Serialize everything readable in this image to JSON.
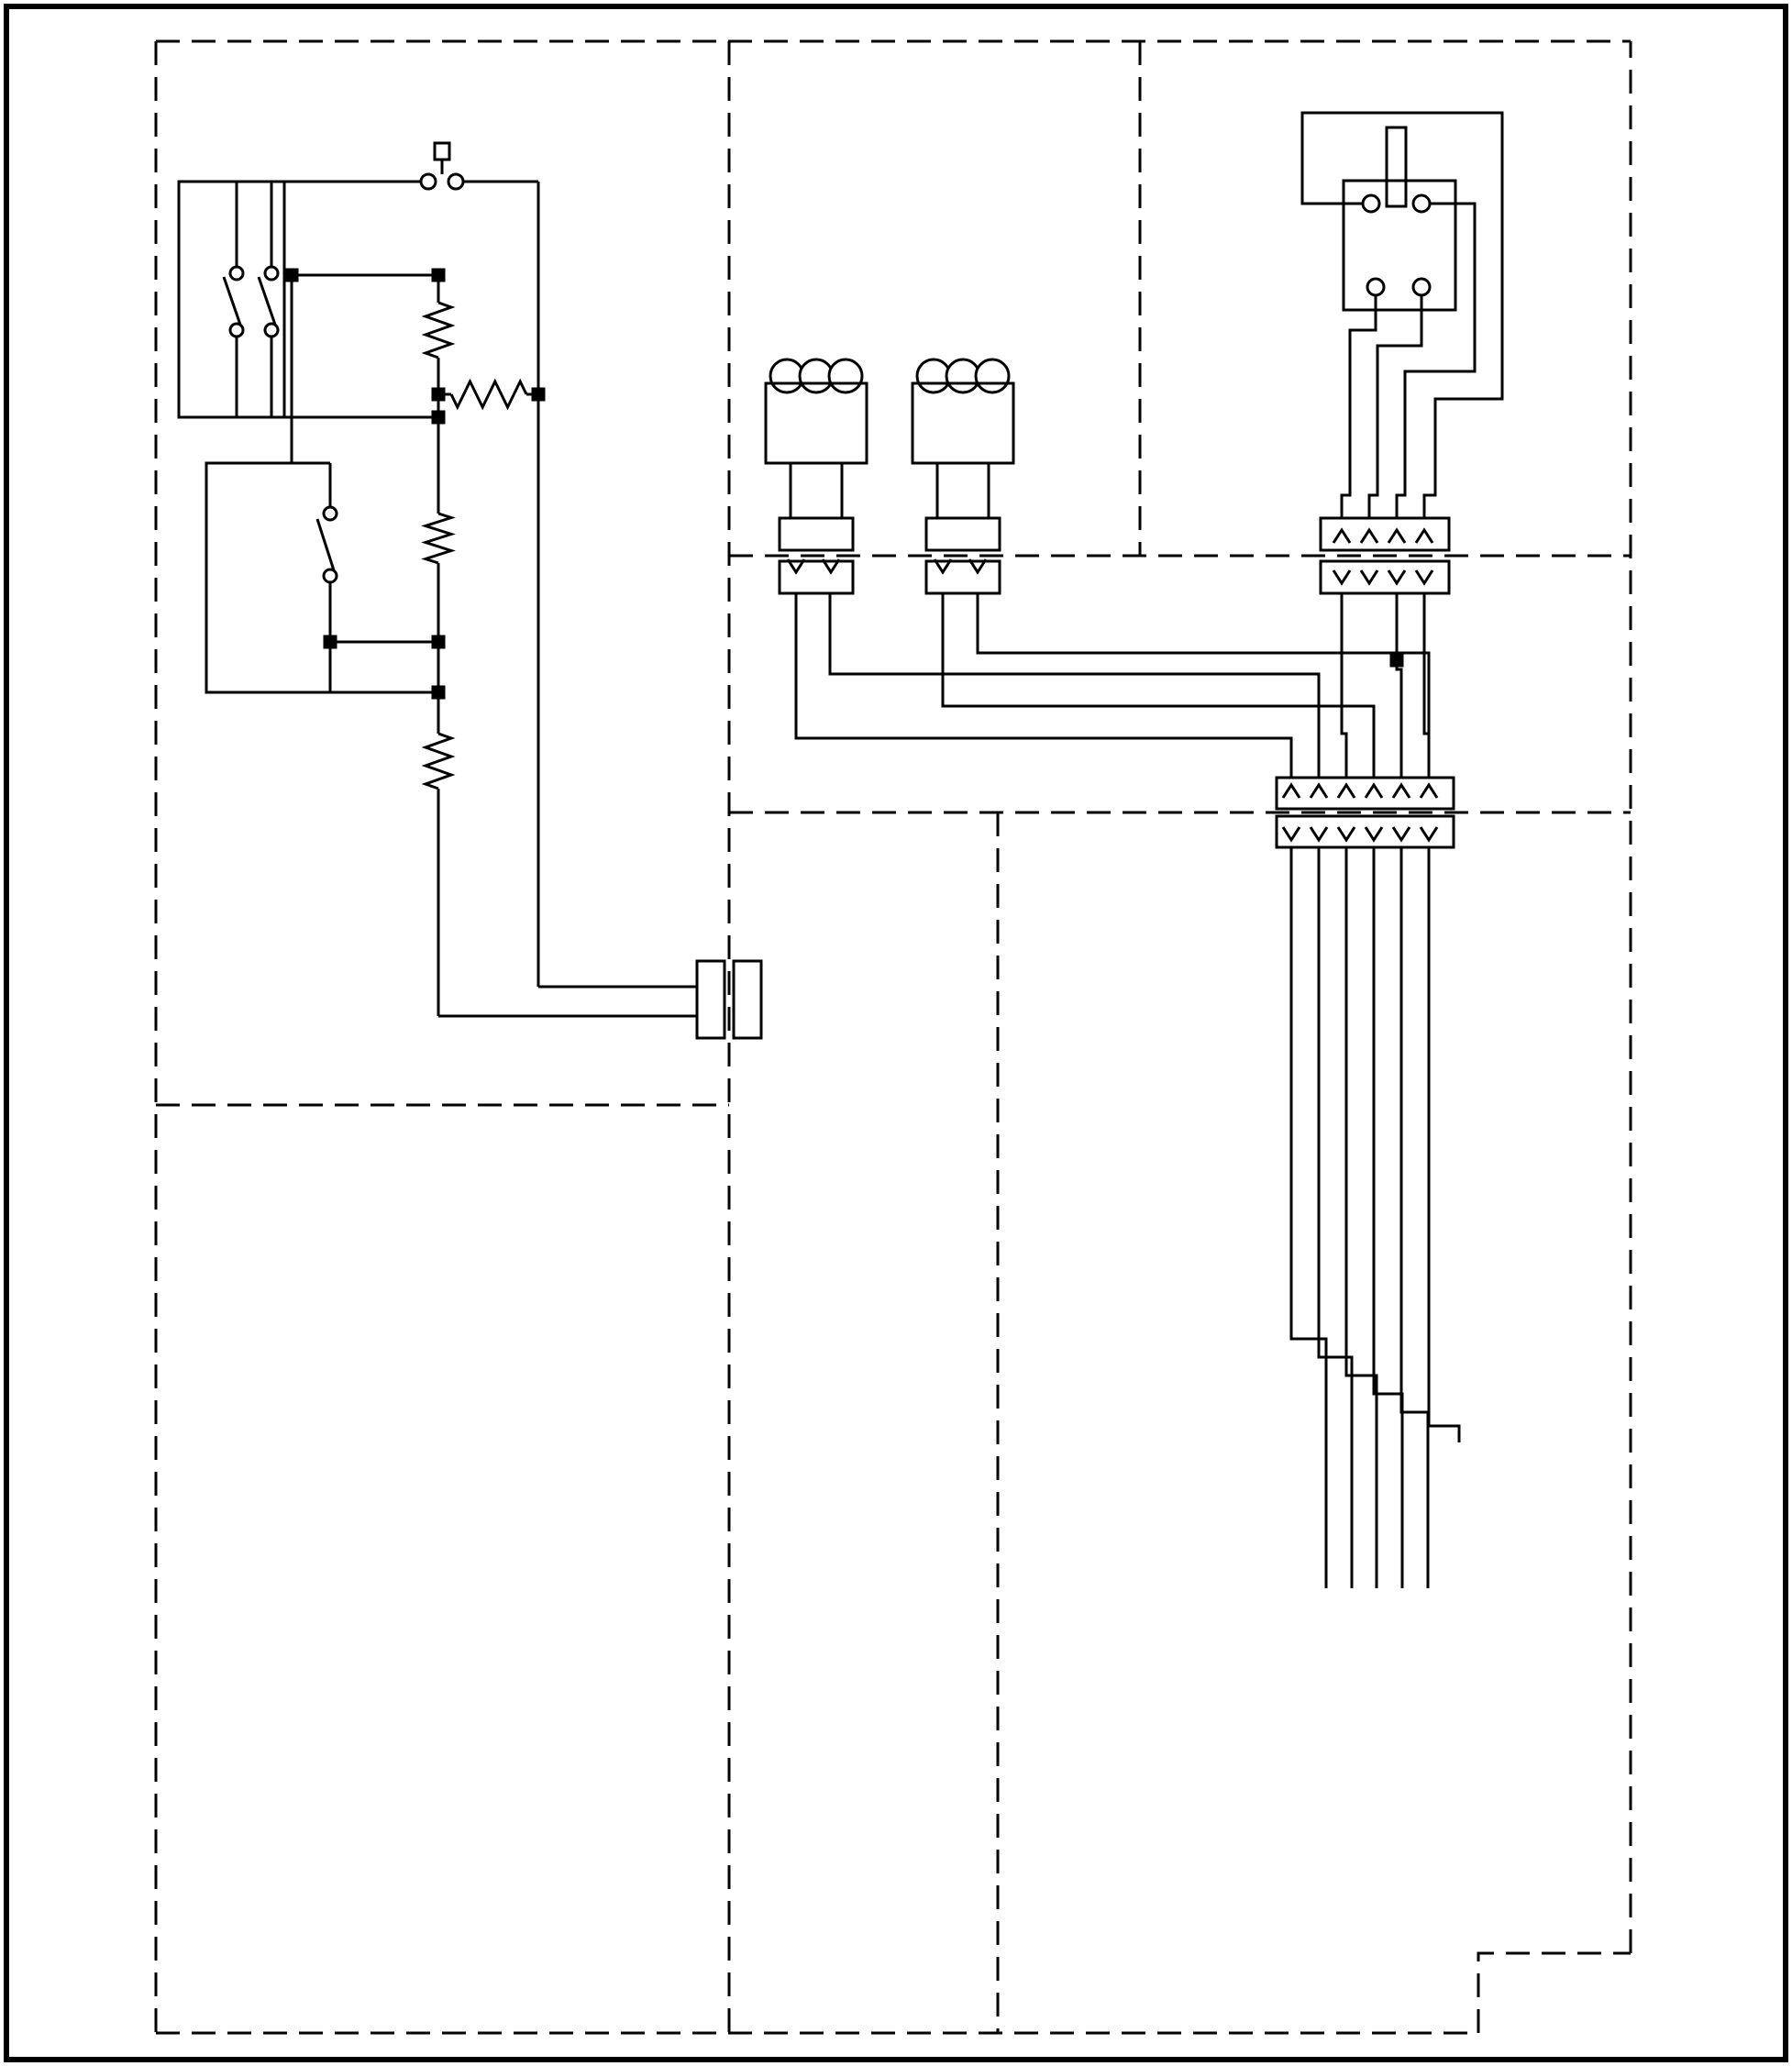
{
  "figure_number": "31257",
  "colors": {
    "ink": "#000000",
    "paper": "#ffffff",
    "junction_shaded": "#6b6b6b"
  },
  "labels": {
    "close_to": [
      "CLOSE TO",
      "SIGNAL A",
      "\"BREAK",
      "TORQUE\"",
      "REQUEST"
    ],
    "on_off": "ON/OFF",
    "system_on": [
      "SHOWN IN",
      "\"SYSTEM ON\"",
      "POSITION"
    ],
    "up_down": "UP/DOWN",
    "upshift": [
      "SHOWN IN",
      "\"UPSHIFT\"",
      "POSITION"
    ],
    "r0": "R0",
    "r1": "R1",
    "r2": "R2",
    "r3": "R3",
    "command_harness": [
      "COMMAND HARNESS",
      "SHIFT KNOB"
    ],
    "high_solenoid": [
      "HIGH",
      "SOLENOID"
    ],
    "low_solenoid": [
      "LOW",
      "SOLENOID"
    ],
    "wiring_harness": "WIRING HARNESS",
    "switch_assembly": [
      "SWITCH ASSEMBLY",
      "SHOWN IN FREE STATE",
      "\"IN NEUTRAL\" SIGNAL"
    ],
    "oem_vehicle_harness": "OEM VEHICLE HARNESS",
    "connectors_at": [
      "CONNECTORS AT",
      "DISCRETION OEM"
    ],
    "clutch_pedal": [
      "CLUTCH PEDAL SWITCH",
      "(PEDAL UP/OUT POSITION)"
    ],
    "set": "SET",
    "resume": "RESUME",
    "pause": "PAUSE",
    "sw_pushbutton_no": "SW PUSHBUTTON NO",
    "sw_pushbutton_nc": "SW PUSHBUTTON NC",
    "cruise_harness": [
      "CRUISE HARNESS",
      "(OPTIONAL)",
      "SHIFT KNOB"
    ],
    "oem_lever_harness": "OEM LEVER HARNESS",
    "ddec_ecm": "DDEC ECM",
    "footnote": [
      "* PIN NO. AT OEM DISCRETION",
      "TYPICAL ASSIGNMENTS SHOWN"
    ]
  },
  "connectors": {
    "solenoid_pins": [
      "A",
      "B"
    ],
    "switch_assembly_conn": [
      "D",
      "C",
      "B",
      "A"
    ],
    "oem_vehicle_conn": [
      "F",
      "E",
      "D",
      "C",
      "B",
      "A"
    ],
    "lever_conn": [
      "G",
      "F",
      "E",
      "D",
      "C",
      "B",
      "A"
    ],
    "knob_conn": [
      "B",
      "A"
    ],
    "cruise_conn": [
      "D",
      "C",
      "B",
      "A"
    ]
  },
  "table": {
    "function_header": "FUNCTION",
    "pin_header": "PIN NO.",
    "star": "*",
    "rows": [
      {
        "function": "SET SW",
        "pin": "*",
        "oem_star": true
      },
      {
        "function": "RESUME SW",
        "pin": "*",
        "oem_star": true
      },
      {
        "function": "PAUSE +",
        "pin": "*",
        "oem_star": true
      },
      {
        "function": "ANALOG SUPPLY (+5V)",
        "pin": "A3",
        "oem_star": false
      },
      {
        "function": "ANALOG SW SIGNAL",
        "pin": "D3",
        "oem_star": false
      },
      {
        "function": "HIGH SOLENOID",
        "pin": "A1",
        "oem_star": true
      },
      {
        "function": "LOW SOLENOID",
        "pin": "F3",
        "oem_star": true
      },
      {
        "function": "IN GEAR SIGNAL",
        "pin": "H1",
        "oem_star": true
      },
      {
        "function": "NEUTRAL SIGNAL",
        "pin": "E1",
        "oem_star": true
      },
      {
        "function": "SWITCHED IGNITION (12V)",
        "pin": "B3",
        "oem_star": false
      },
      {
        "function": "VSS (+)",
        "pin": "E2",
        "oem_star": false
      },
      {
        "function": "VSS (-)",
        "pin": "E3",
        "oem_star": false
      }
    ]
  }
}
